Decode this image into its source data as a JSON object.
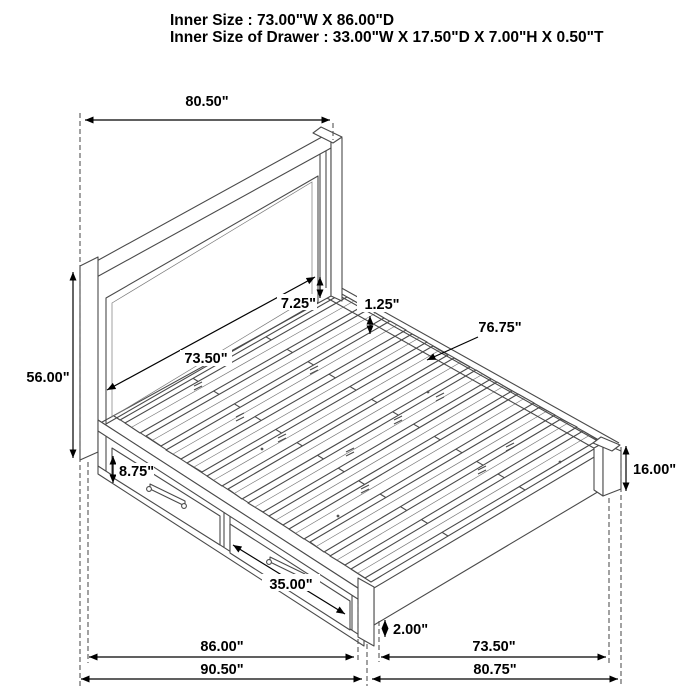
{
  "title": {
    "line1": "Inner Size : 73.00\"W X 86.00\"D",
    "line2": "Inner Size of Drawer : 33.00\"W X 17.50\"D X 7.00\"H X 0.50\"T"
  },
  "dimensions": {
    "headboard_width": "80.50\"",
    "headboard_height": "56.00\"",
    "headboard_panel_width": "73.50\"",
    "headboard_to_rail": "7.25\"",
    "rail_lip": "1.25\"",
    "slat_deck_length": "76.75\"",
    "drawer_front_height": "8.75\"",
    "drawer_front_width": "35.00\"",
    "platform_height": "16.00\"",
    "foot_clearance": "2.00\"",
    "side_length": "86.00\"",
    "overall_depth": "90.50\"",
    "foot_inner_width": "73.50\"",
    "overall_width": "80.75\""
  },
  "colors": {
    "line_art": "#4a4a4a",
    "dimension_lines": "#000000",
    "background": "#ffffff"
  }
}
